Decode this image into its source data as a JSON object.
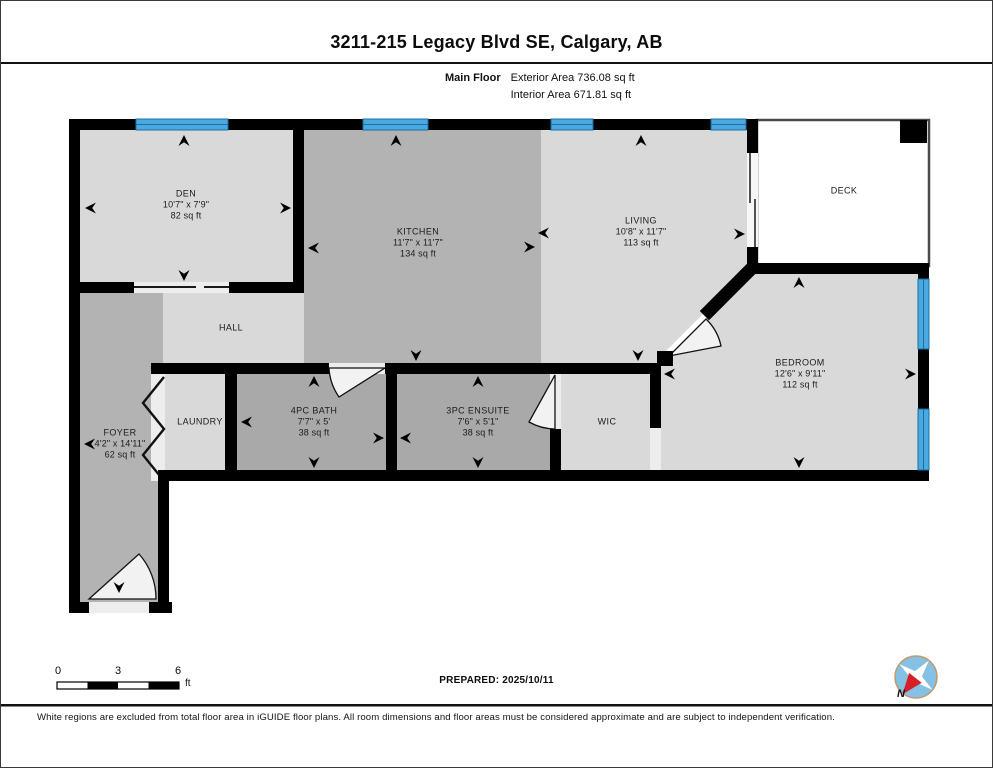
{
  "header": {
    "title": "3211-215 Legacy Blvd SE, Calgary, AB",
    "floor_label": "Main Floor",
    "exterior_area": "Exterior Area 736.08 sq ft",
    "interior_area": "Interior Area 671.81 sq ft"
  },
  "rooms": {
    "den": {
      "name": "DEN",
      "dims": "10'7\" x 7'9\"",
      "area": "82 sq ft"
    },
    "kitchen": {
      "name": "KITCHEN",
      "dims": "11'7\" x 11'7\"",
      "area": "134 sq ft"
    },
    "living": {
      "name": "LIVING",
      "dims": "10'8\" x 11'7\"",
      "area": "113 sq ft"
    },
    "deck": {
      "name": "DECK"
    },
    "bedroom": {
      "name": "BEDROOM",
      "dims": "12'6\" x 9'11\"",
      "area": "112 sq ft"
    },
    "wic": {
      "name": "WIC"
    },
    "ensuite": {
      "name": "3PC ENSUITE",
      "dims": "7'6\" x 5'1\"",
      "area": "38 sq ft"
    },
    "bath": {
      "name": "4PC BATH",
      "dims": "7'7\" x 5'",
      "area": "38 sq ft"
    },
    "laundry": {
      "name": "LAUNDRY"
    },
    "foyer": {
      "name": "FOYER",
      "dims": "4'2\" x 14'11\"",
      "area": "62 sq ft"
    },
    "hall": {
      "name": "HALL"
    }
  },
  "scale_bar": {
    "labels": [
      "0",
      "3",
      "6"
    ],
    "unit": "ft"
  },
  "footer": {
    "prepared": "PREPARED: 2025/10/11",
    "compass_label": "N",
    "disclaimer": "White regions are excluded from total floor area in iGUIDE floor plans. All room dimensions and floor areas must be considered approximate and are subject to independent verification."
  },
  "colors": {
    "wall": "#000000",
    "window_glass": "#4aa9de",
    "window_frame": "#1b6fa5",
    "room_light": "#d9d9d9",
    "room_medium": "#b3b3b3",
    "room_dark": "#a9a9a9",
    "deck_white": "#ffffff",
    "threshold": "#ededed",
    "compass_blue": "#85c1e5",
    "compass_red": "#d61f26"
  }
}
